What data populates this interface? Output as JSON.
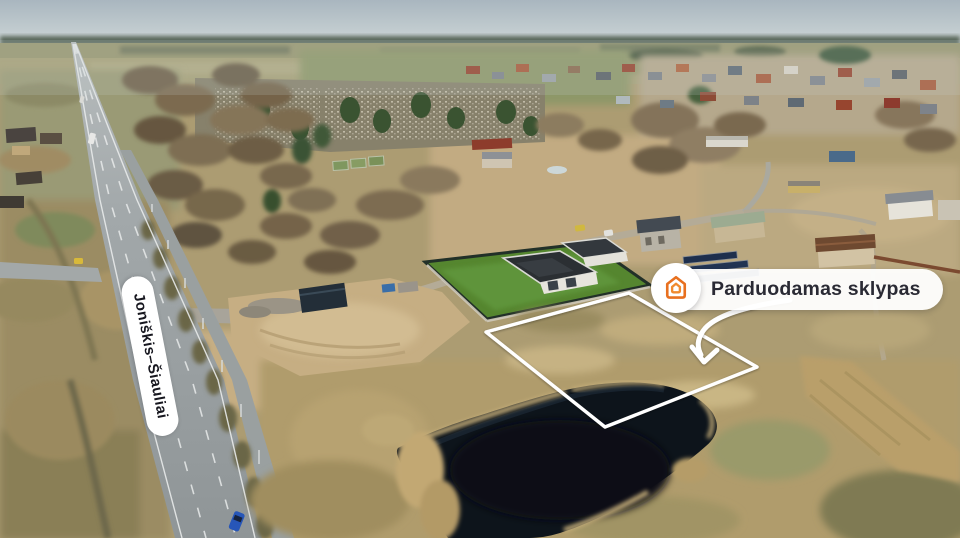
{
  "scene": {
    "description": "Aerial drone photo of a land plot for sale beside the Joniskis-Siauliai highway, with a pond, a modern house with green lawn, a village in the background and annotation overlays"
  },
  "road_label": {
    "text": "Joniškis–Šiauliai"
  },
  "badge": {
    "text": "Parduodamas sklypas",
    "icon": "house-logo-icon"
  },
  "colors": {
    "accent_orange": "#e8701f",
    "badge_background": "#ffffff",
    "badge_text": "#2a2a34",
    "annotation_white": "#ffffff"
  }
}
